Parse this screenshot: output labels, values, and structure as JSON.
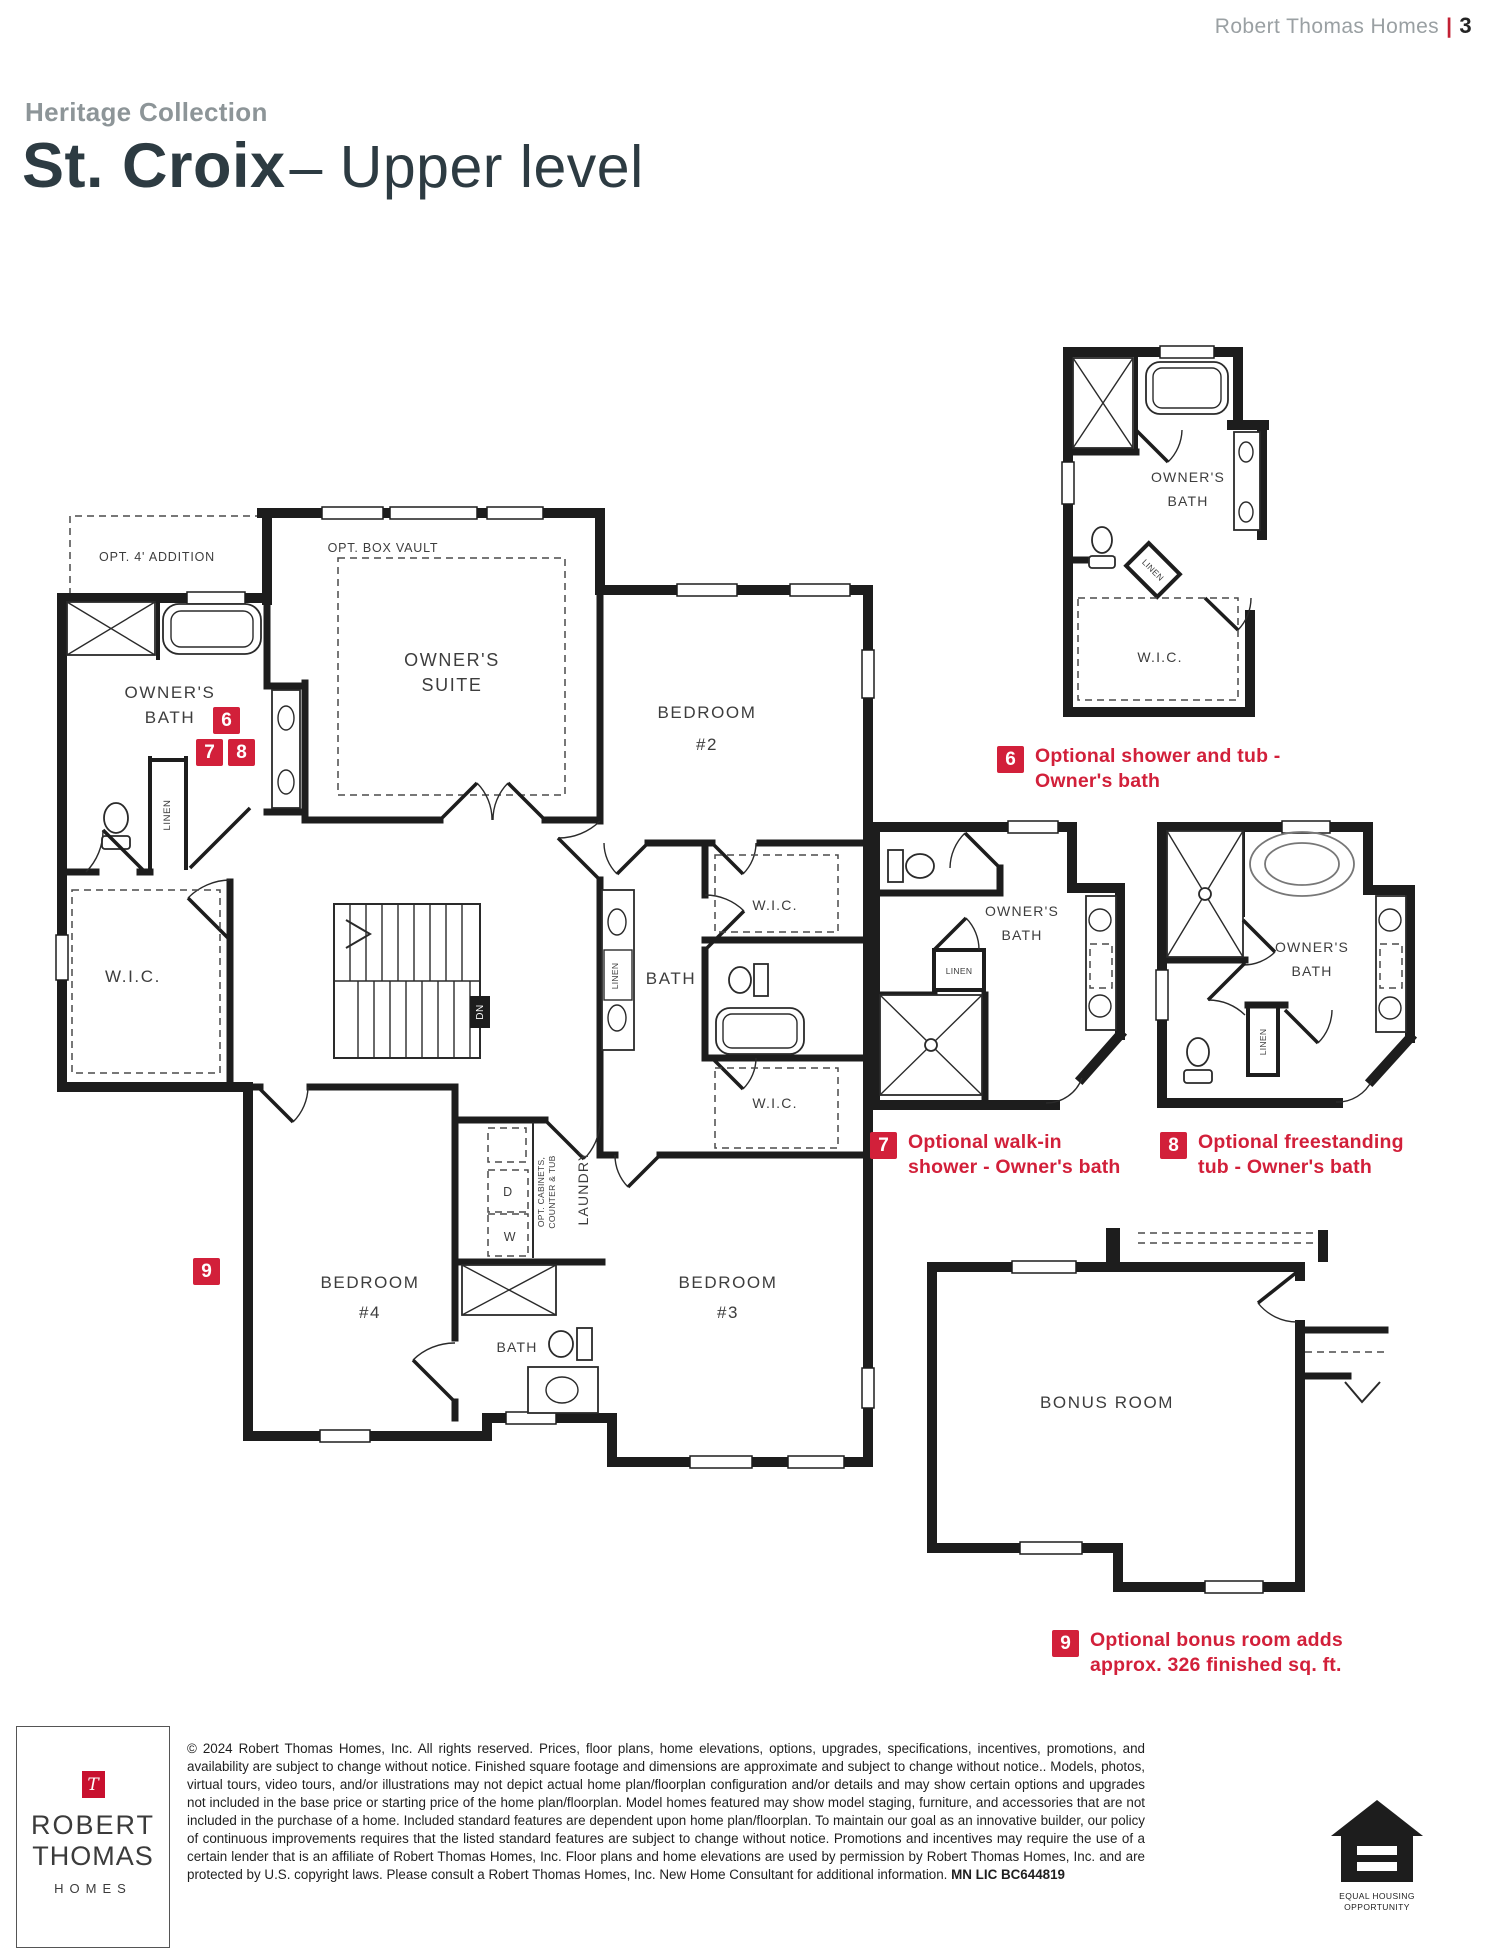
{
  "header": {
    "brand": "Robert Thomas Homes",
    "divider": "|",
    "page_number": "3"
  },
  "title": {
    "collection": "Heritage Collection",
    "model": "St. Croix",
    "level": "– Upper level"
  },
  "plan": {
    "labels": {
      "opt_addition": "OPT. 4' ADDITION",
      "opt_box_vault": "OPT. BOX VAULT",
      "owners_suite": [
        "OWNER'S",
        "SUITE"
      ],
      "owners_bath": [
        "OWNER'S",
        "BATH"
      ],
      "bedroom2": [
        "BEDROOM",
        "#2"
      ],
      "bedroom3": [
        "BEDROOM",
        "#3"
      ],
      "bedroom4": [
        "BEDROOM",
        "#4"
      ],
      "wic": "W.I.C.",
      "bath": "BATH",
      "linen": "LINEN",
      "laundry": "LAUNDRY",
      "opt_cabinets": [
        "OPT. CABINETS,",
        "COUNTER & TUB"
      ],
      "dryer": "D",
      "washer": "W",
      "down": "DN"
    }
  },
  "detail": {
    "bonus_room": "BONUS ROOM"
  },
  "options": [
    {
      "num": "6",
      "line1": "Optional shower and tub -",
      "line2": "Owner's bath"
    },
    {
      "num": "7",
      "line1": "Optional walk-in",
      "line2": "shower - Owner's bath"
    },
    {
      "num": "8",
      "line1": "Optional freestanding",
      "line2": "tub - Owner's bath"
    },
    {
      "num": "9",
      "line1": "Optional bonus room adds",
      "line2": "approx. 326 finished sq. ft."
    }
  ],
  "footer": {
    "logo": {
      "mark": "T",
      "name_line1": "ROBERT",
      "name_line2": "THOMAS",
      "name_line3": "HOMES"
    },
    "legal": "© 2024 Robert Thomas Homes, Inc. All rights reserved. Prices, floor plans, home elevations, options, upgrades, specifications, incentives, promotions, and availability are subject to change without notice. Finished square footage and dimensions are approximate and subject to change without notice.. Models, photos, virtual tours, video tours, and/or illustrations may not depict actual home plan/floorplan configuration and/or details and may show certain options and upgrades not included in the base price or starting price of the home plan/floorplan. Model homes featured may show model staging, furniture, and accessories that are not included in the purchase of a home. Included standard features are dependent upon home plan/floorplan. To maintain our goal as an innovative builder, our policy of continuous improvements requires that the listed standard features are subject to change without notice. Promotions and incentives may require the use of a certain lender that is an affiliate of Robert Thomas Homes, Inc. Floor plans and home elevations are used by permission by Robert Thomas Homes, Inc. and are protected by U.S. copyright laws. Please consult a Robert Thomas Homes, Inc. New Home Consultant for additional information. ",
    "license": "MN LIC BC644819",
    "eho": {
      "line1": "EQUAL HOUSING",
      "line2": "OPPORTUNITY"
    }
  },
  "colors": {
    "accent": "#d2203a",
    "logo_red": "#c8102e",
    "title": "#2d3b42",
    "muted": "#8d9598",
    "wall": "#1d1d1d"
  }
}
